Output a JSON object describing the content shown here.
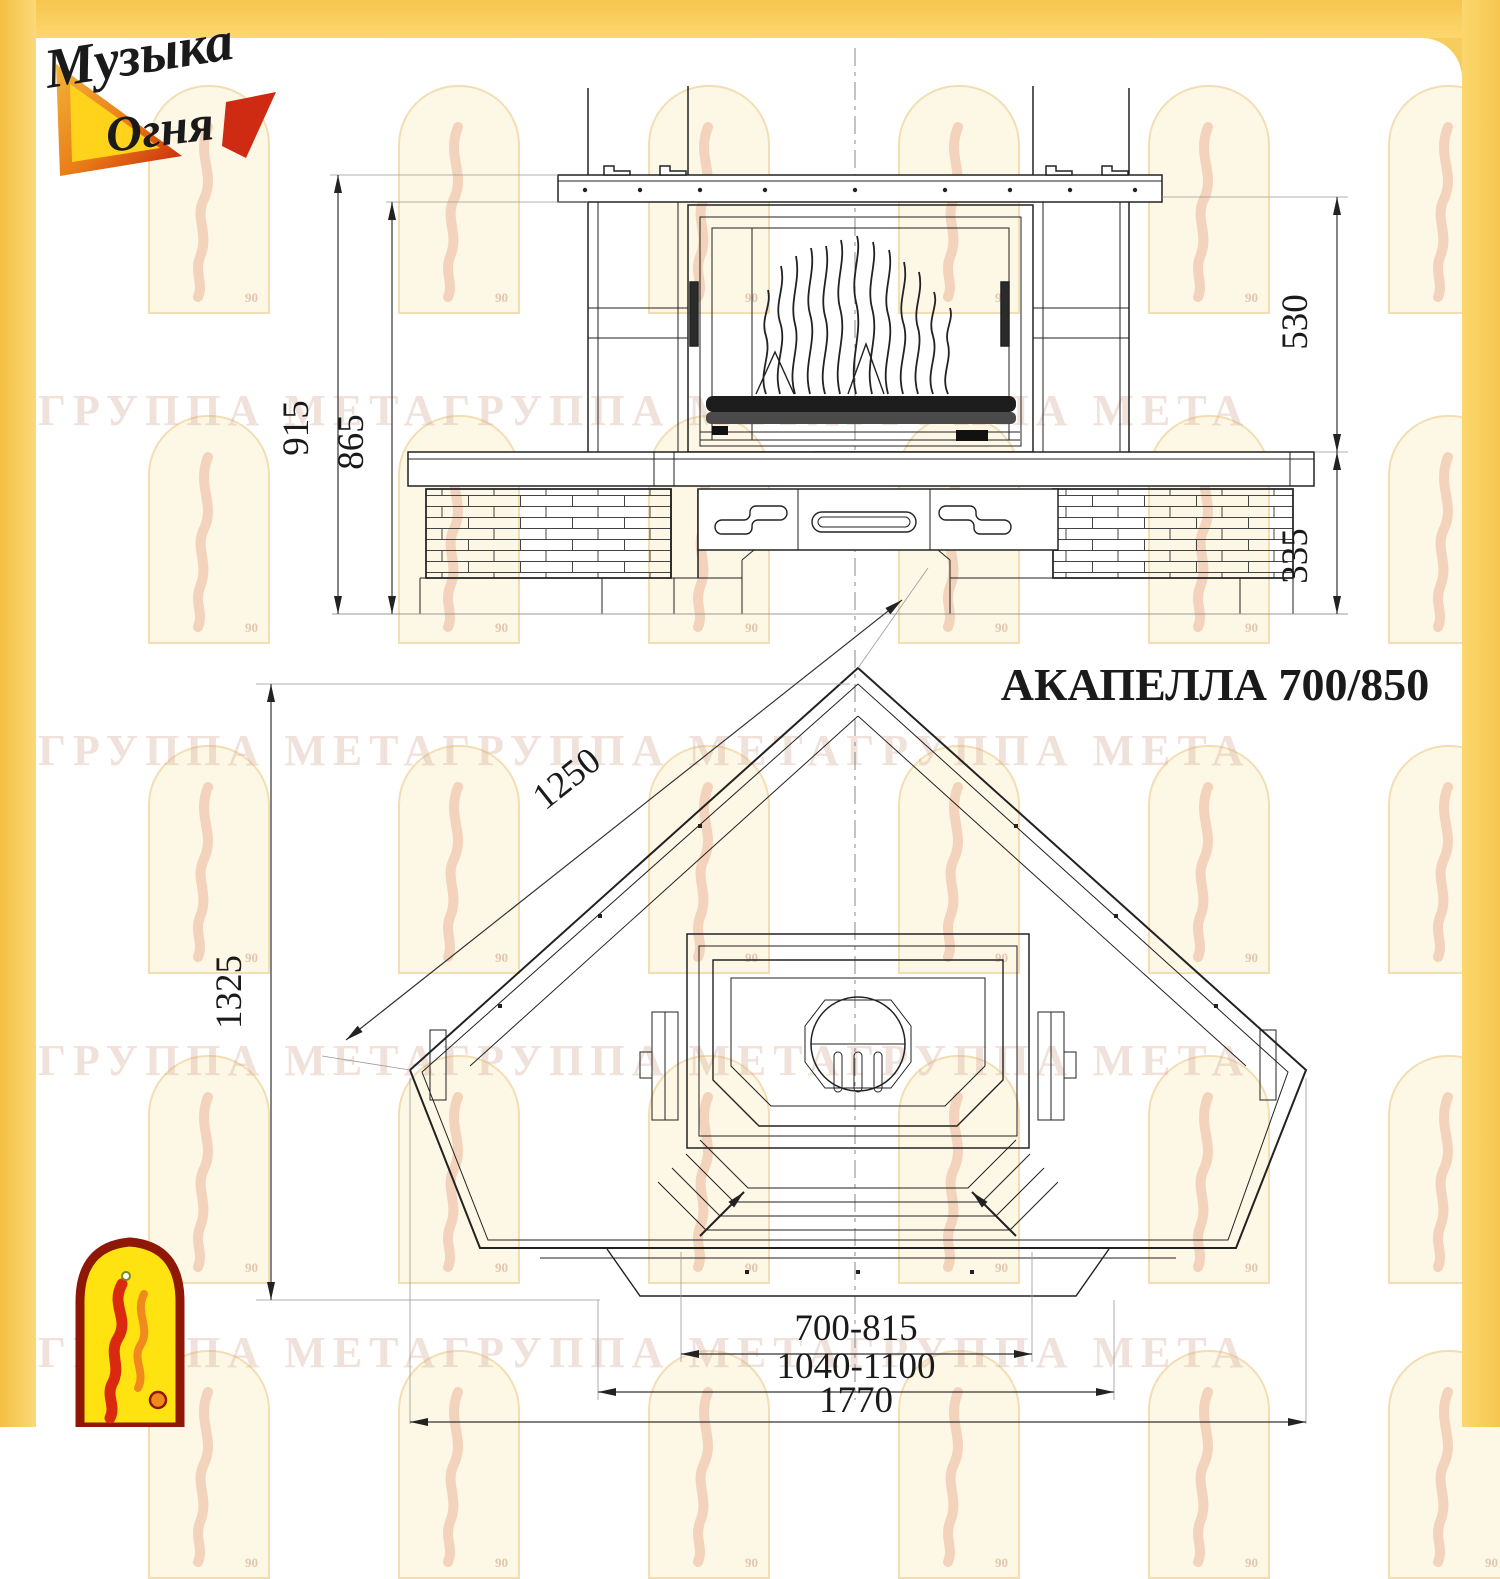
{
  "colors": {
    "frame_yellow": "#F8CC5C",
    "paper": "#FFFFFF",
    "line": "#222222",
    "watermark_text_color": "rgba(205,160,135,0.30)"
  },
  "brand": {
    "logo_line1": "Музыка",
    "logo_line2": "Огня"
  },
  "watermark": {
    "text": "ГРУППА МЕТАГРУППА МЕТАГРУППА МЕТА",
    "badge": "90"
  },
  "drawing": {
    "title": "АКАПЕЛЛА 700/850",
    "front_view": {
      "dims": {
        "total_height": "915",
        "firebox_height": "865",
        "upper_height": "530",
        "base_height": "335"
      }
    },
    "plan_view": {
      "dims": {
        "side_edge": "1250",
        "depth": "1325",
        "firebox_width": "700-815",
        "portal_width": "1040-1100",
        "overall_width": "1770"
      }
    }
  }
}
